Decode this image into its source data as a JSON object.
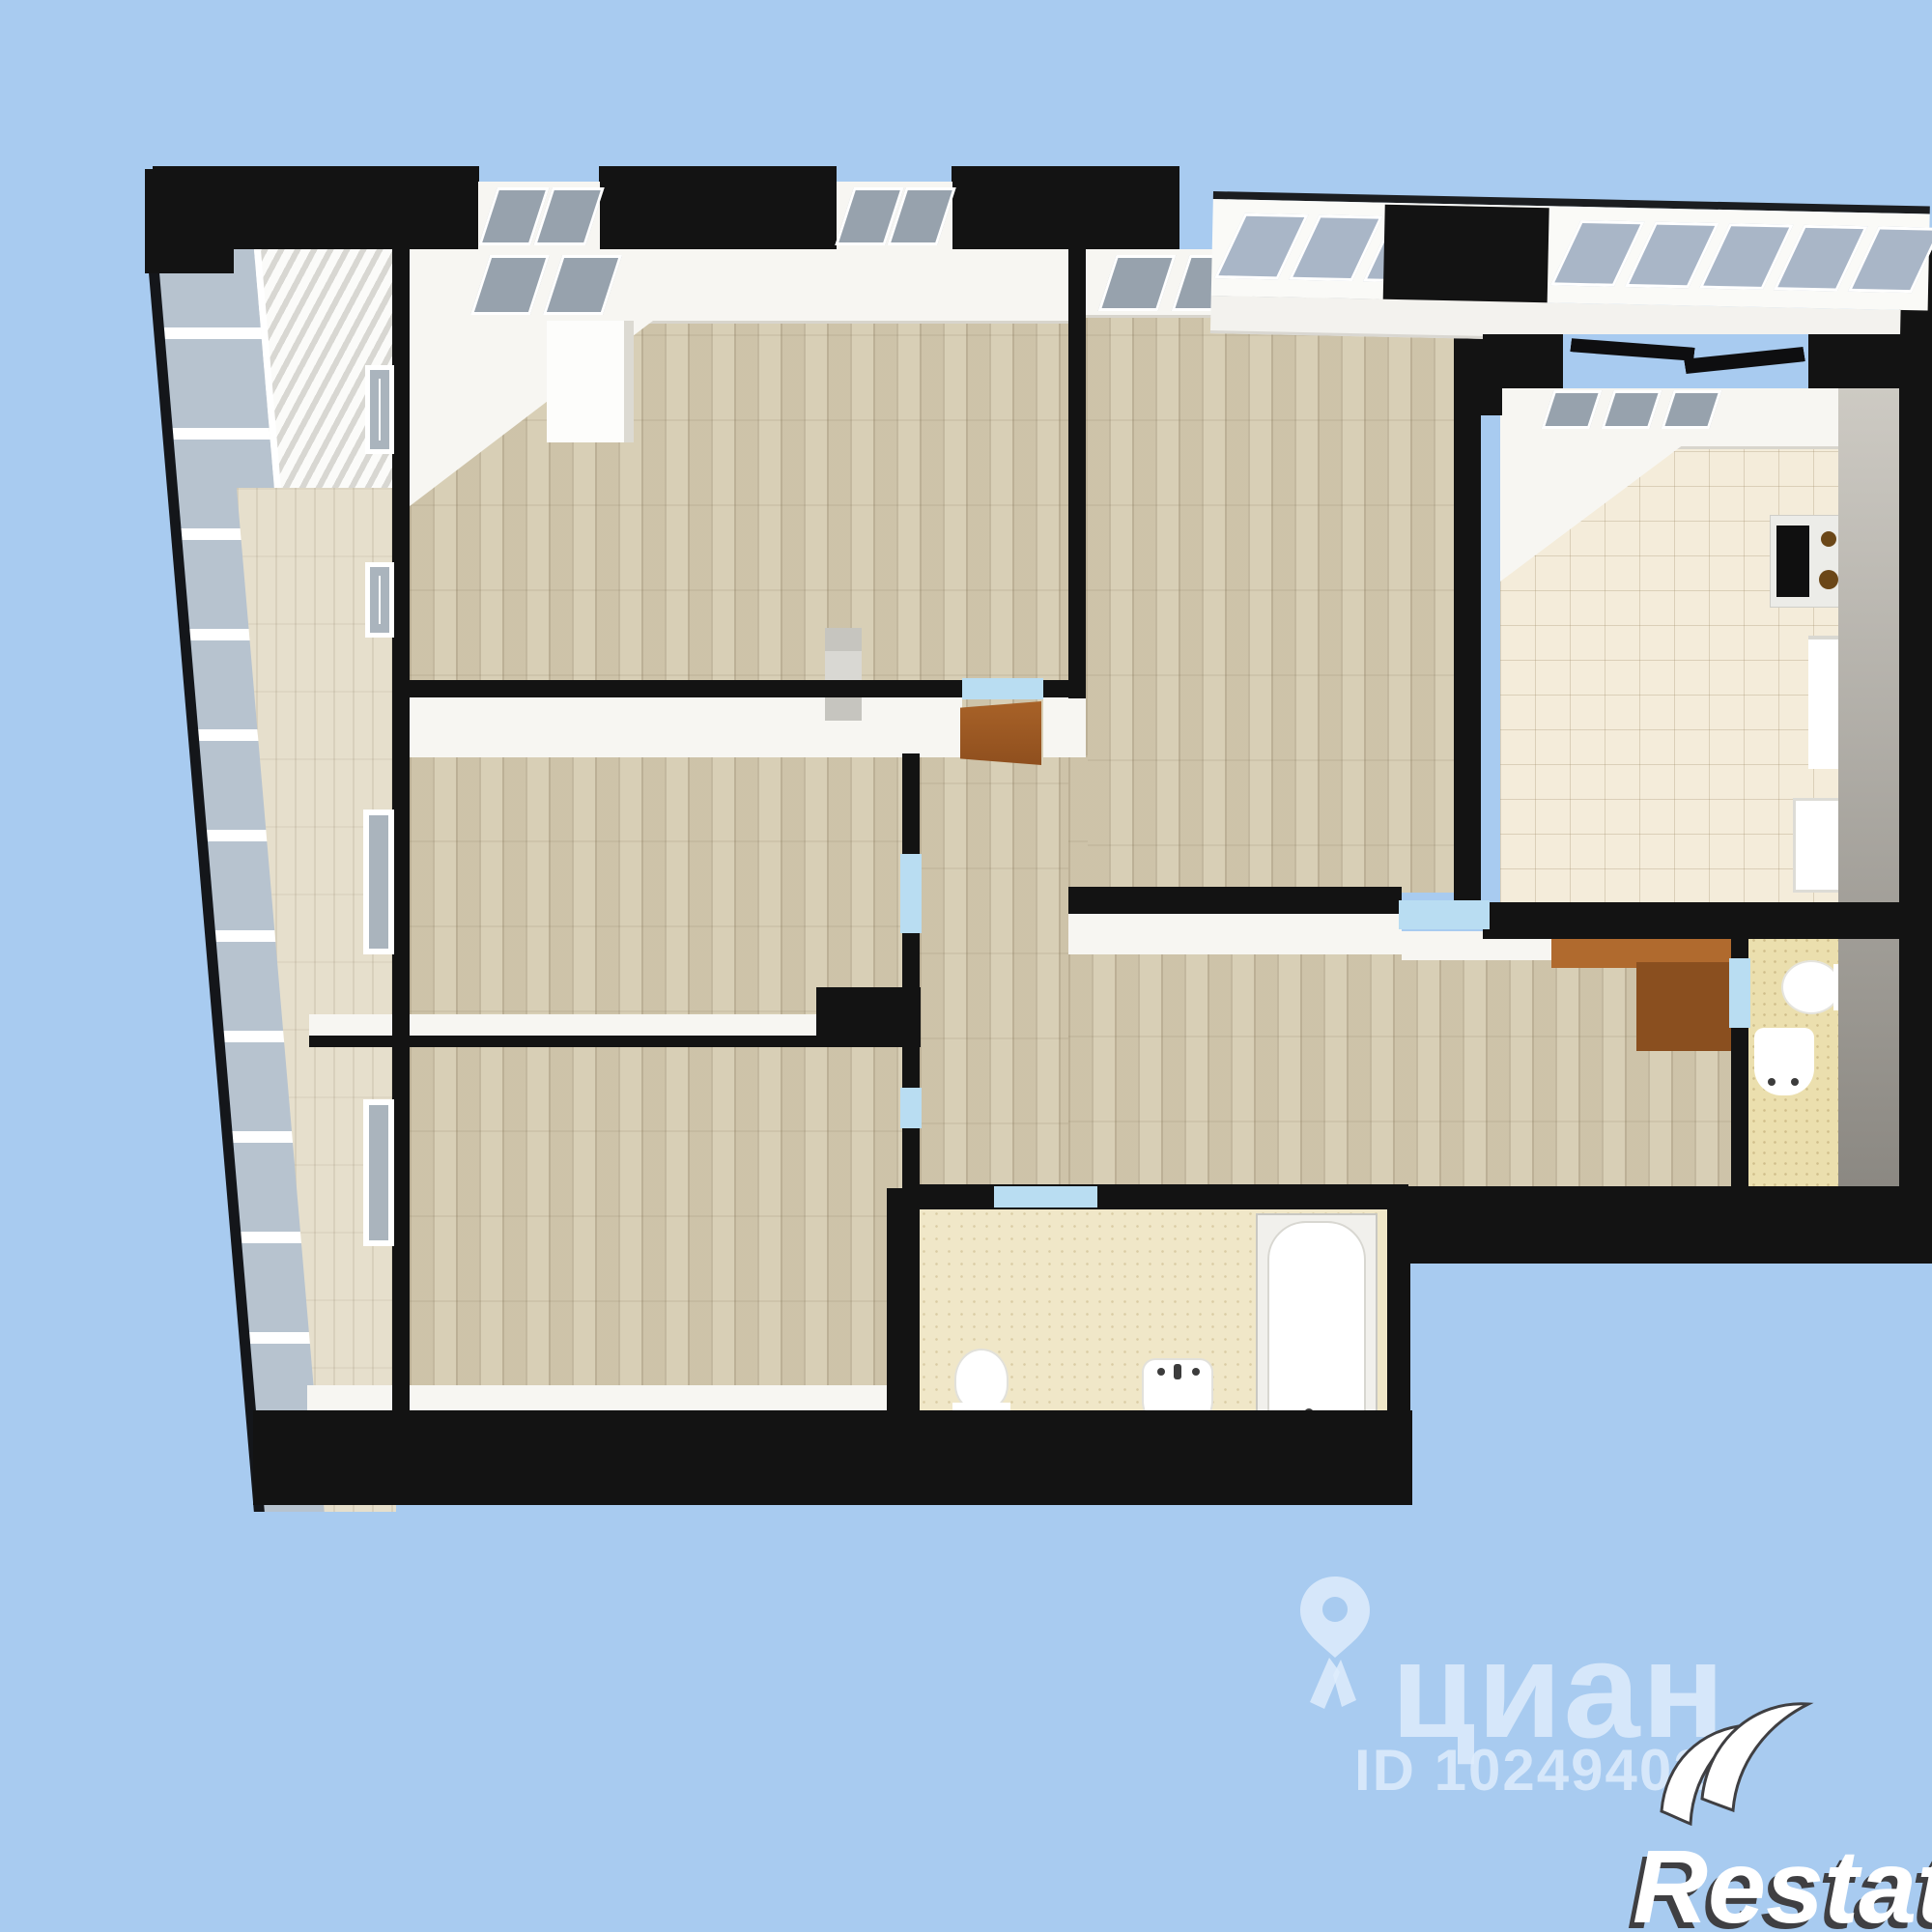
{
  "image_type": "3d-floor-plan-render",
  "watermarks": {
    "cian": {
      "logo_text": "циан",
      "id_text": "ID 10249402",
      "color": "#deecfb",
      "icon": "cian-pin-icon"
    },
    "restate": {
      "logo_text": "Restate",
      "fill": "#ffffff",
      "outline": "#3f3f42",
      "icon": "double-crescent-icon"
    }
  },
  "palette": {
    "background": "#a8cbf0",
    "wall": "#131313",
    "wall_face": "#f7f6f2",
    "parquet": "#d8cfb6",
    "parquet_light": "#e6dfcc",
    "kitchen_tile": "#f4ecda",
    "bathroom_tile": "#f0e7c8",
    "wc_tile": "#ebdfae",
    "door_threshold": "#b9ddf2",
    "wood_door": "#a05a24",
    "glass": "#97a2ad",
    "side_wall_gray": "#b3b0aa"
  },
  "rooms": [
    {
      "name": "loggia-left"
    },
    {
      "name": "room-top-left"
    },
    {
      "name": "room-top-right"
    },
    {
      "name": "kitchen"
    },
    {
      "name": "corridor"
    },
    {
      "name": "room-middle-left"
    },
    {
      "name": "room-bottom-left"
    },
    {
      "name": "bathroom"
    },
    {
      "name": "wc"
    }
  ],
  "fixtures": [
    "stove",
    "fridge",
    "kitchen-sink",
    "bathtub",
    "toilet",
    "sink",
    "wardrobe",
    "radiator",
    "open-door"
  ]
}
